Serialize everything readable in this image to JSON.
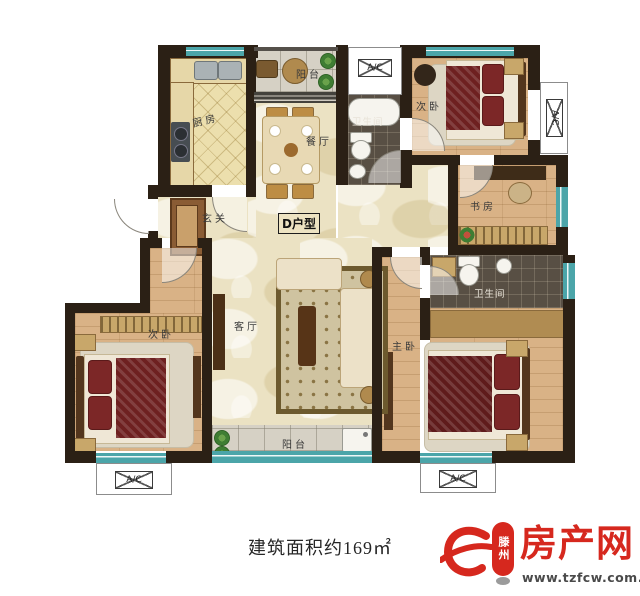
{
  "unit": {
    "label": "D户型"
  },
  "caption": "建筑面积约169㎡",
  "rooms": {
    "balcony_top": "阳台",
    "kitchen": "厨房",
    "dining": "餐厅",
    "bath_top": "卫生间",
    "bedroom_top_right": "次卧",
    "study": "书房",
    "foyer": "玄关",
    "living": "客厅",
    "bedroom_bottom_left": "次卧",
    "master_bedroom": "主卧",
    "bath_master": "卫生间",
    "balcony_bottom": "阳台"
  },
  "hvac": {
    "ac_label": "A/C"
  },
  "logo": {
    "city": "滕州",
    "brand": "房产网",
    "url": "www.tzfcw.com.cn",
    "brand_color": "#d6281e"
  },
  "colors": {
    "wall": "#2b2015",
    "window_teal": "#4ba5a9",
    "marble_floor": "#ebe2c3",
    "wood_floor": "#d9b286",
    "dark_tile": "#584f44",
    "gray_tile": "#d6d1c5",
    "kitchen_tile": "#ecdfad",
    "accent_red": "#d6281e"
  }
}
